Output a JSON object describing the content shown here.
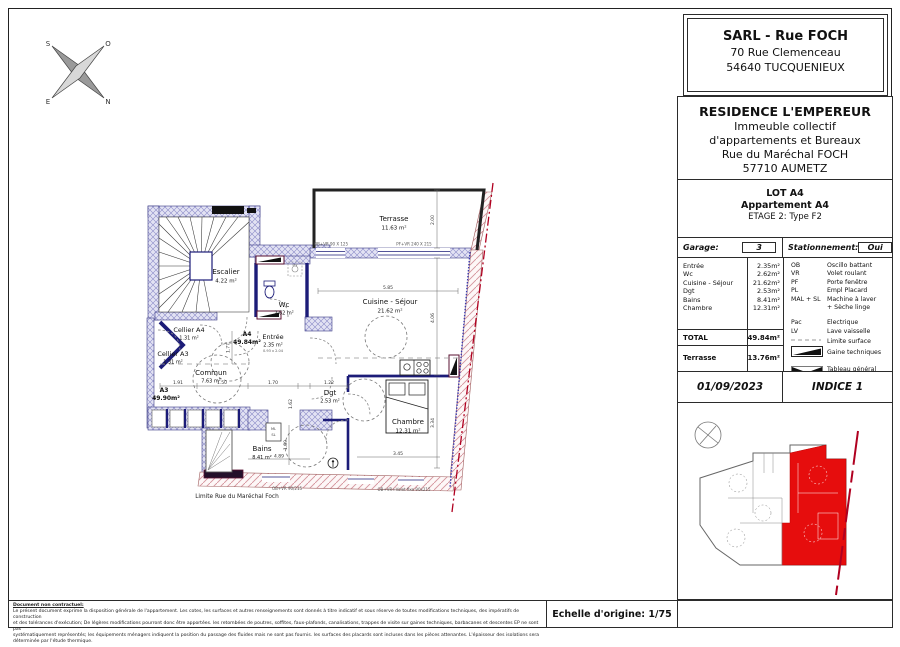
{
  "title_block": {
    "company": {
      "name": "SARL - Rue FOCH",
      "address1": "70 Rue Clemenceau",
      "address2": "54640 TUCQUENIEUX"
    },
    "residence": {
      "name": "RESIDENCE L'EMPEREUR",
      "line1": "Immeuble collectif",
      "line2": "d'appartements et Bureaux",
      "line3": "Rue du Maréchal FOCH",
      "line4": "57710 AUMETZ"
    },
    "lot": {
      "line1": "LOT A4",
      "line2": "Appartement  A4",
      "line3": "ETAGE 2: Type F2"
    },
    "garage": {
      "label": "Garage:",
      "value": "3",
      "stationnement_label": "Stationnement:",
      "stationnement_value": "Oui"
    },
    "room_table": [
      {
        "name": "Entrée",
        "value": "2.35m²"
      },
      {
        "name": "Wc",
        "value": "2.62m²"
      },
      {
        "name": "Cuisine - Séjour",
        "value": "21.62m²"
      },
      {
        "name": "Dgt",
        "value": "2.53m²"
      },
      {
        "name": "Bains",
        "value": "8.41m²"
      },
      {
        "name": "Chambre",
        "value": "12.31m²"
      }
    ],
    "abbreviations": [
      {
        "abbr": "OB",
        "text": "Oscillo battant"
      },
      {
        "abbr": "VR",
        "text": "Volet roulant"
      },
      {
        "abbr": "PF",
        "text": "Porte fenêtre"
      },
      {
        "abbr": "PL",
        "text": "Empl Placard"
      },
      {
        "abbr": "MAL + SL",
        "text": "Machine à laver",
        "text2": "+ Sèche linge"
      }
    ],
    "power": [
      {
        "abbr": "Pac",
        "text": "Electrique"
      },
      {
        "abbr": "LV",
        "text": "Lave vaisselle"
      }
    ],
    "symbols": {
      "dash": "Limite surface",
      "wedge": "Gaine techniques",
      "bowtie1": "Tableau général",
      "bowtie2": "Basse tension"
    },
    "total": {
      "label": "TOTAL",
      "value": "49.84m²"
    },
    "terrasse": {
      "label": "Terrasse",
      "value": "13.76m²"
    },
    "date": "01/09/2023",
    "indice": "INDICE 1"
  },
  "plan": {
    "rooms": {
      "terrasse": {
        "name": "Terrasse",
        "area": "11.63 m²"
      },
      "escalier": {
        "name": "Escalier",
        "area": "4.22 m²"
      },
      "wc": {
        "name": "Wc",
        "area": "2.62 m²"
      },
      "cuisine": {
        "name": "Cuisine - Séjour",
        "area": "21.62 m²"
      },
      "cellier_a4": {
        "name": "Cellier A4",
        "area": "1.31 m²"
      },
      "cellier_a3": {
        "name": "Cellier A3",
        "area": "1.31 m²"
      },
      "commun": {
        "name": "Commun",
        "area": "7.63 m²"
      },
      "entree": {
        "name": "Entrée",
        "area": "2.35 m²"
      },
      "dgt": {
        "name": "Dgt",
        "area": "2.53 m²"
      },
      "chambre": {
        "name": "Chambre",
        "area": "12.31 m²"
      },
      "bains": {
        "name": "Bains",
        "area": "8.41 m²"
      }
    },
    "units": {
      "a4_name": "A4",
      "a4_area": "49.84m²",
      "a3_name": "A3",
      "a3_area": "49.90m²"
    },
    "compass": {
      "top_left": "S",
      "top_right": "O",
      "bottom_left": "E",
      "bottom_right": "N"
    },
    "street_label": "Limite Rue du Maréchal Foch",
    "windows": {
      "w1": "OB+VR 90 X 125",
      "w2": "PF+VR 240 X 215",
      "w3": "OB+VR 90/215",
      "w4": "OB+VR+Volet fixe 90x215"
    },
    "door_note": "0.93 x 2.04",
    "appliances": {
      "ml": "ML",
      "sl": "SL",
      "lav": "lav"
    },
    "dims": {
      "d200": "2.00",
      "d585": "5.85",
      "d406": "4.06",
      "d334": "3.34",
      "d345": "3.45",
      "d191": "1.91",
      "d150": "1.50",
      "d170": "1.70",
      "d122": "1.22",
      "d489": "4.89",
      "d189": "1.89",
      "d177": "1.77",
      "d162": "1.62"
    }
  },
  "footer": {
    "heading": "Document non contractuel:",
    "line1": "Le présent document exprime la disposition générale de l'appartement. Les cotes, les surfaces et autres renseignements sont donnés à titre indicatif et sous réserve de toutes modifications techniques, des impératifs de construction",
    "line2": "et des tolérances d'exécution; De légères modifications pourront donc être apportées. les retombées de poutres, soffites, faux-plafonds, canalisations, trappes de visite sur gaines techniques, barbacanes et descentes EP ne sont pas",
    "line3": "systématiquement représentés; les équipements ménagers indiquent la position du passage des fluides mais ne sont pas fournis. les surfaces des placards sont incluses dans les pièces attenantes. L'épaisseur des isolations sera déterminée par l'étude thermique.",
    "echelle": "Echelle d'origine: 1/75"
  },
  "colors": {
    "accent_red": "#cc1111",
    "wall_navy": "#1c1c78",
    "hatch_blue": "#8a8ac8",
    "hatch_pink": "#d4939b"
  }
}
